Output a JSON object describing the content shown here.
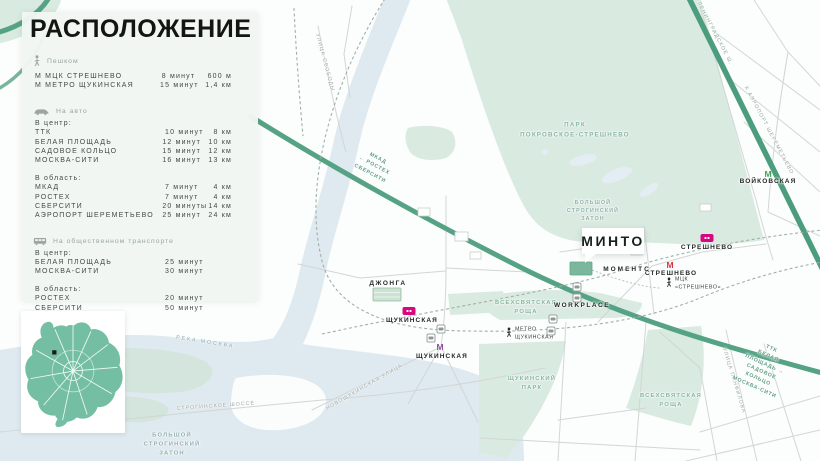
{
  "colors": {
    "panel_bg": "#f1f6f3",
    "map_bg": "#fcfdfd",
    "park_green": "#d9eae0",
    "water_blue": "#dfe9f0",
    "road_green": "#55a384",
    "rail_badge_magenta": "#d6077f",
    "metro_red": "#d6343c",
    "metro_purple": "#8e4d9e",
    "metro_green": "#3fa553",
    "minimap_green": "#74bfa3"
  },
  "panel": {
    "title": "РАСПОЛОЖЕНИЕ",
    "sections": {
      "walk": {
        "label": "Пешком",
        "rows": [
          {
            "name": "М  МЦК СТРЕШНЕВО",
            "time": "8 минут",
            "dist": "600 м"
          },
          {
            "name": "М  МЕТРО ЩУКИНСКАЯ",
            "time": "15 минут",
            "dist": "1,4 км"
          }
        ]
      },
      "auto": {
        "label": "На авто",
        "group1_label": "В центр:",
        "group1": [
          {
            "name": "ТТК",
            "time": "10 минут",
            "dist": "8 км"
          },
          {
            "name": "БЕЛАЯ ПЛОЩАДЬ",
            "time": "12 минут",
            "dist": "10 км"
          },
          {
            "name": "САДОВОЕ КОЛЬЦО",
            "time": "15 минут",
            "dist": "12 км"
          },
          {
            "name": "МОСКВА-СИТИ",
            "time": "16 минут",
            "dist": "13 км"
          }
        ],
        "group2_label": "В область:",
        "group2": [
          {
            "name": "МКАД",
            "time": "7 минут",
            "dist": "4 км"
          },
          {
            "name": "РОСТЕХ",
            "time": "7 минут",
            "dist": "4 км"
          },
          {
            "name": "СБЕРСИТИ",
            "time": "20 минуты",
            "dist": "14 км"
          },
          {
            "name": "АЭРОПОРТ ШЕРЕМЕТЬЕВО",
            "time": "25 минут",
            "dist": "24 км"
          }
        ]
      },
      "transit": {
        "label": "На общественном транспорте",
        "group1_label": "В центр:",
        "group1": [
          {
            "name": "БЕЛАЯ ПЛОЩАДЬ",
            "time": "25 минут"
          },
          {
            "name": "МОСКВА-СИТИ",
            "time": "30 минут"
          }
        ],
        "group2_label": "В область:",
        "group2": [
          {
            "name": "РОСТЕХ",
            "time": "20 минут"
          },
          {
            "name": "СБЕРСИТИ",
            "time": "50 минут"
          }
        ]
      }
    }
  },
  "map": {
    "callout": {
      "text": "МИНТО"
    },
    "icons": {
      "metro_m": "М"
    },
    "stations": {
      "voykovskaya": "ВОЙКОВСКАЯ",
      "streshnevo_d2": "СТРЕШНЕВО",
      "streshnevo_mck": "СТРЕШНЕВО",
      "mck_streshnevo_walk": "МЦК\n«СТРЕШНЕВО»",
      "shchukinskaya_d2": "ЩУКИНСКАЯ",
      "shchukinskaya_metro": "ЩУКИНСКАЯ",
      "metro_shchukinskaya_walk": "МЕТРО\nЩУКИНСКАЯ"
    },
    "places": {
      "workplace": "WORKPLACE",
      "moments": "МОМЕНТС",
      "dzhonga": "ДЖОНГА"
    },
    "areas": {
      "park_pokrovskoe": "ПАРК\nПОКРОВСКОЕ-СТРЕШНЕВО",
      "zaton_top": "БОЛЬШОЙ\nСТРОГИНСКИЙ\nЗАТОН",
      "zaton_bottom": "БОЛЬШОЙ\nСТРОГИНСКИЙ\nЗАТОН",
      "vsekhsvyatskaya_1": "ВСЕХСВЯТСКАЯ\nРОЩА",
      "vsekhsvyatskaya_2": "ВСЕХСВЯТСКАЯ\nРОЩА",
      "shchukinsky_park": "ЩУКИНСКИЙ\nПАРК",
      "reka_moskva": "РЕКА МОСКВА"
    },
    "streets": {
      "svobody": "УЛИЦА СВОБОДЫ",
      "leningradskoe": "ЛЕНИНГРАДСКОЕ Ш.",
      "stroginskoe": "СТРОГИНСКОЕ ШОССЕ",
      "novoshchukinskaya": "НОВОЩУКИНСКАЯ УЛИЦА",
      "panfilova": "УЛИЦА ПАНФИЛОВА"
    },
    "directions": {
      "mkad": "МКАД\n← РОСТЕХ\nСБЕРСИТИ",
      "ttk": "ТТК\nБЕЛАЯ ПЛОЩАДЬ →\nСАДОВОЕ КОЛЬЦО\nМОСКВА-СИТИ",
      "sheremetyevo": "К АЭРОПОРТ ШЕРЕМЕТЬЕВО"
    }
  }
}
